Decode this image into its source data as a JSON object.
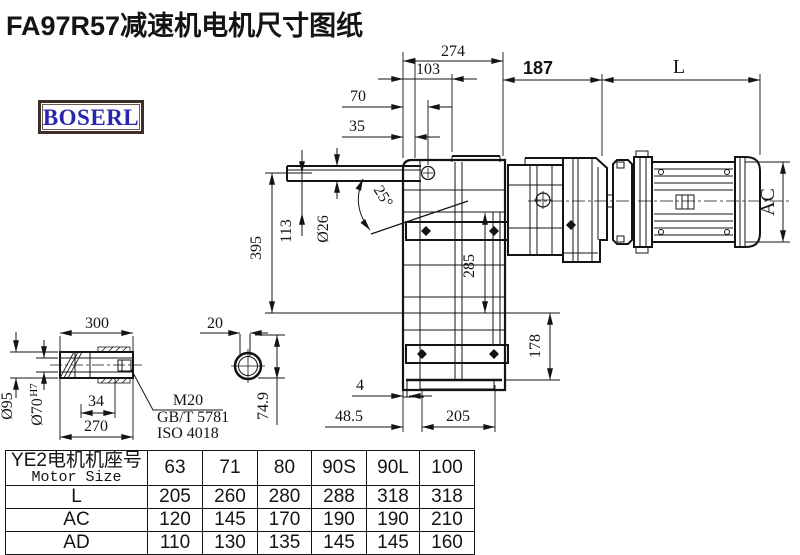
{
  "title": "FA97R57减速机电机尺寸图纸",
  "logo": {
    "text": "BOSERL",
    "border_color": "#3f2e28",
    "text_color": "#2727ad"
  },
  "colors": {
    "ink": "#141414",
    "background": "#ffffff"
  },
  "drawing": {
    "dims": {
      "d274": "274",
      "d103": "103",
      "d70": "70",
      "d35": "35",
      "d187": "187",
      "L": "L",
      "AC": "AC",
      "d395": "395",
      "d113": "113",
      "d26": "Ø26",
      "a25": "25°",
      "d285": "285",
      "d178": "178",
      "d4": "4",
      "d485": "48.5",
      "d205": "205",
      "d300": "300",
      "d95": "Ø95",
      "d70h7": "Ø70",
      "h7": "H7",
      "d34": "34",
      "d270": "270",
      "d20": "20",
      "d749": "74.9",
      "m20": "M20",
      "gbt": "GB/T 5781",
      "iso": "ISO 4018"
    }
  },
  "table": {
    "header_cn": "YE2电机机座号",
    "header_en": "Motor Size",
    "columns": [
      "63",
      "71",
      "80",
      "90S",
      "90L",
      "100"
    ],
    "rows": [
      {
        "label": "L",
        "values": [
          "205",
          "260",
          "280",
          "288",
          "318",
          "318"
        ]
      },
      {
        "label": "AC",
        "values": [
          "120",
          "145",
          "170",
          "190",
          "190",
          "210"
        ]
      },
      {
        "label": "AD",
        "values": [
          "110",
          "130",
          "135",
          "145",
          "145",
          "160"
        ]
      }
    ]
  }
}
